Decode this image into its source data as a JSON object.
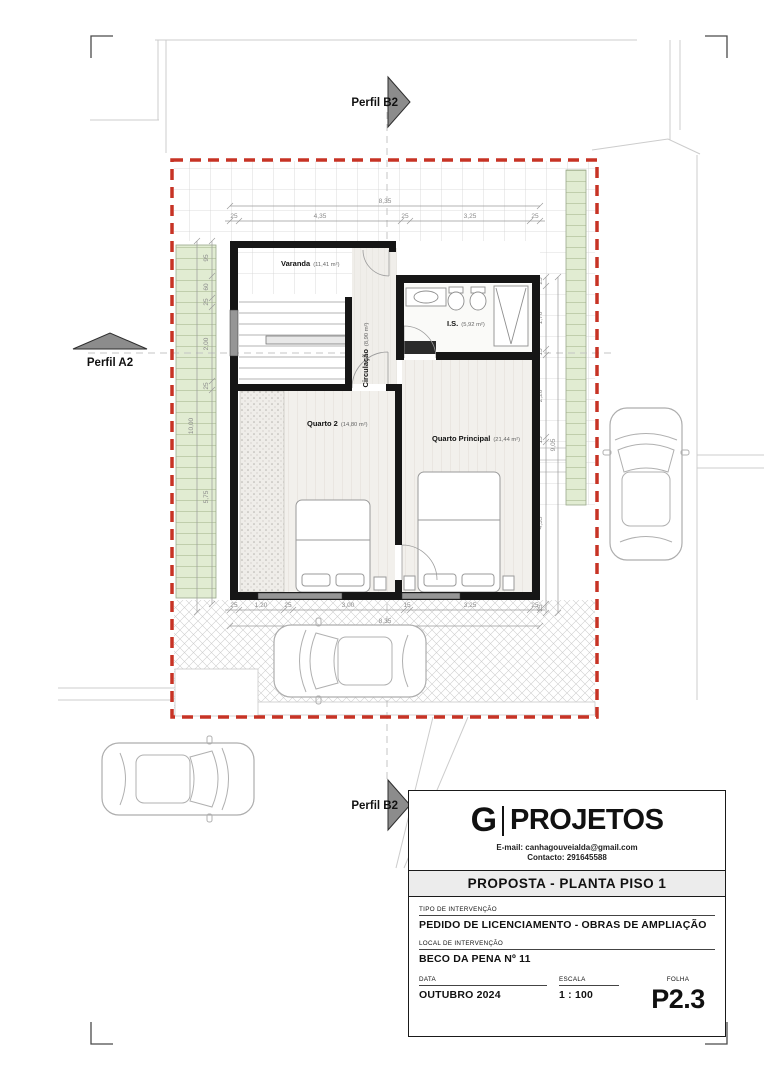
{
  "markers": {
    "top": "Perfil B2",
    "left": "Perfil A2",
    "bottom": "Perfil B2"
  },
  "rooms": {
    "varanda": {
      "name": "Varanda",
      "area": "(11,41 m²)"
    },
    "is": {
      "name": "I.S.",
      "area": "(5,92 m²)"
    },
    "circulacao": {
      "name": "Circulação",
      "area": "(8,90 m²)"
    },
    "quarto2": {
      "name": "Quarto 2",
      "area": "(14,80 m²)"
    },
    "quarto_principal": {
      "name": "Quarto Principal",
      "area": "(21,44 m²)"
    }
  },
  "dims": {
    "top": {
      "overall": "8,35",
      "segments": [
        "25",
        "4,35",
        "25",
        "3,25",
        "25"
      ]
    },
    "bottom": {
      "overall": "8,35",
      "segments": [
        "25",
        "1,20",
        "25",
        "3,00",
        "15",
        "3,25",
        "25"
      ]
    },
    "left": {
      "overall": "10,00",
      "segments": [
        "95",
        "60",
        "25",
        "2,00",
        "25",
        "5,75"
      ]
    },
    "right": {
      "overall": "9,05",
      "segments": [
        "25",
        "1,70",
        "15",
        "2,20",
        "15",
        "4,35",
        "25"
      ]
    }
  },
  "title_block": {
    "logo_letter": "G",
    "logo_name": "PROJETOS",
    "email": "E-mail: canhagouveialda@gmail.com",
    "contact": "Contacto: 291645588",
    "sheet_title": "PROPOSTA - PLANTA PISO 1",
    "fields": {
      "tipo_label": "TIPO DE INTERVENÇÃO",
      "tipo_value": "PEDIDO DE LICENCIAMENTO - OBRAS DE AMPLIAÇÃO",
      "local_label": "LOCAL DE INTERVENÇÃO",
      "local_value": "BECO DA PENA Nº 11",
      "data_label": "DATA",
      "data_value": "OUTUBRO 2024",
      "escala_label": "ESCALA",
      "escala_value": "1 : 100",
      "folha_label": "FOLHA",
      "folha_value": "P2.3"
    }
  },
  "colors": {
    "boundary_red": "#c73325",
    "garden_green": "#e1ecd2",
    "wall_black": "#161616"
  }
}
